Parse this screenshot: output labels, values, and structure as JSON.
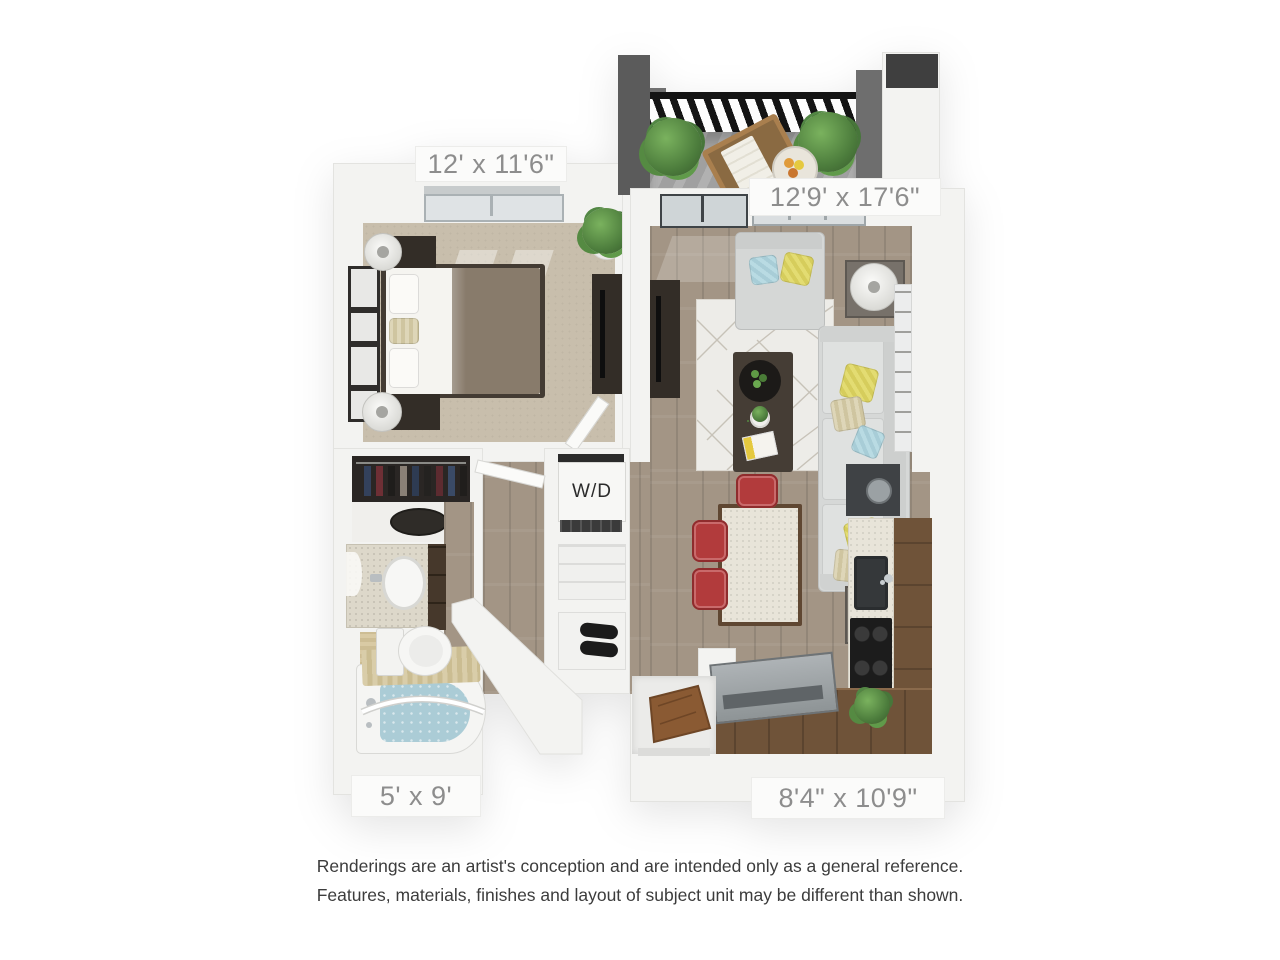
{
  "type": "floor-plan-rendering",
  "labels": {
    "bedroom_dimensions": "12' x 11'6\"",
    "living_balcony_dimensions": "12'9' x 17'6\"",
    "bathroom_dimensions": "5' x 9'",
    "kitchen_dimensions": "8'4\" x 10'9\"",
    "washer_dryer": "W/D"
  },
  "disclaimer": {
    "line1": "Renderings are an artist's conception and are intended only as a general reference.",
    "line2": "Features, materials, finishes and layout of subject unit may be different than shown."
  },
  "colors": {
    "background": "#ffffff",
    "wall": "#f3f3f1",
    "bedroom_carpet": "#c8beac",
    "wood_floor": "#a39585",
    "balcony_floor": "#a0a0a0",
    "cabinet_wood": "#6f5339",
    "stool_red": "#b23b3c",
    "tub_water": "#abccd6",
    "dimension_text": "#8d8d8d",
    "disclaimer_text": "#3c3c3c"
  }
}
